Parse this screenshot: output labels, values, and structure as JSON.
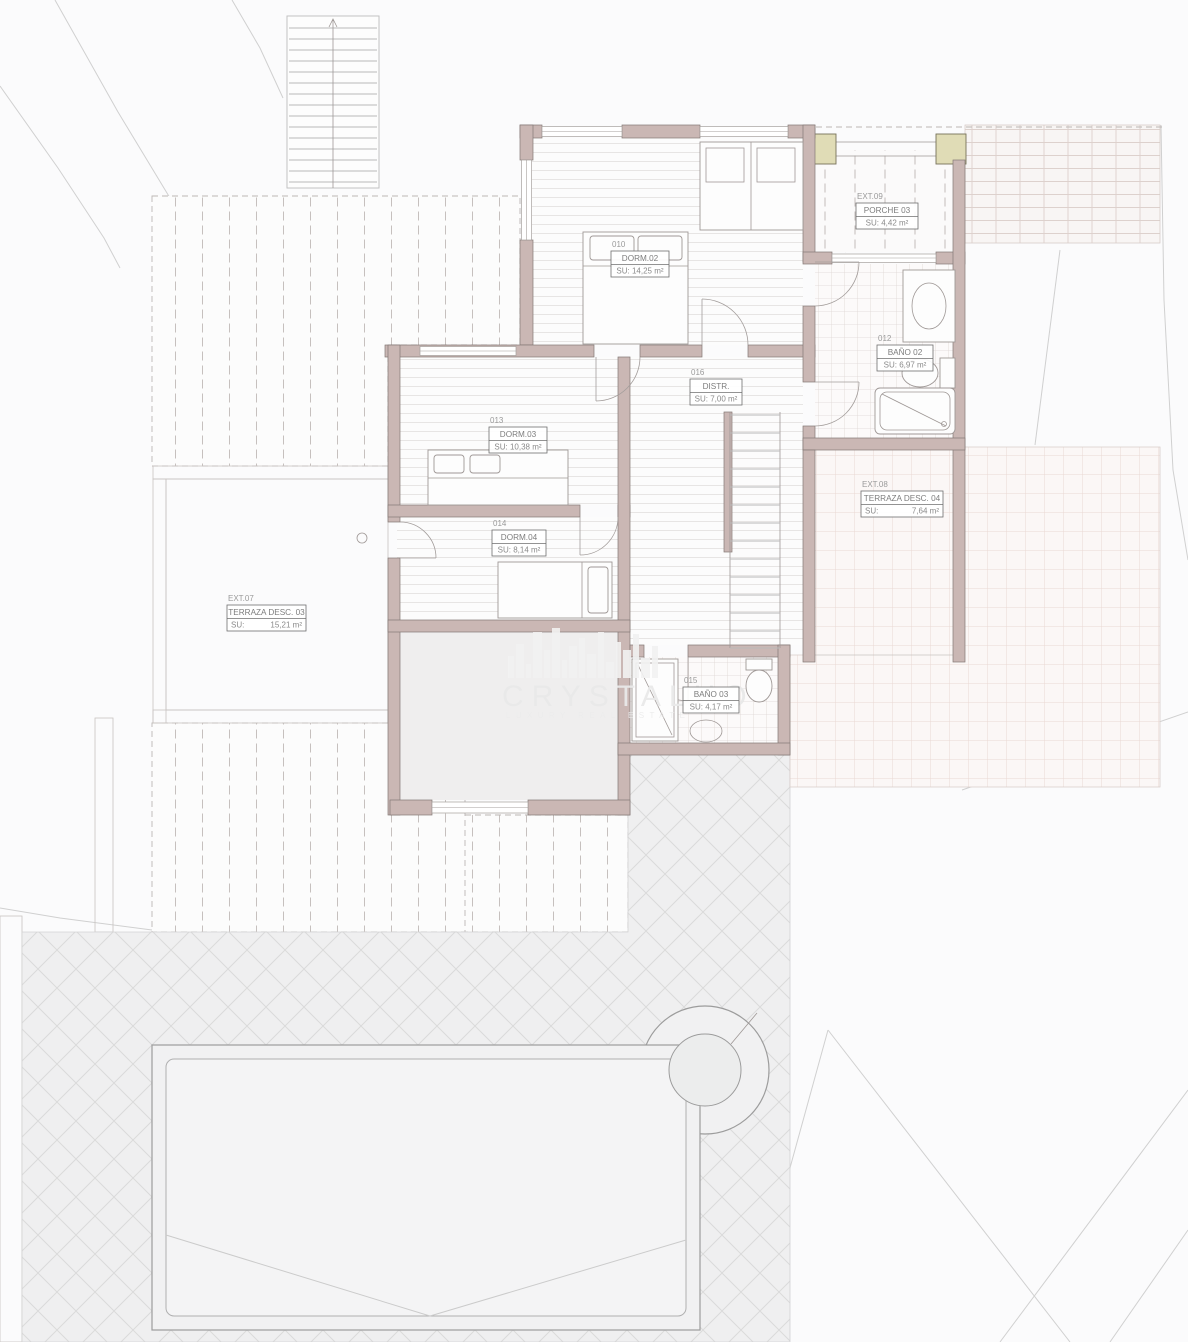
{
  "plan": {
    "type": "architectural-floor-plan",
    "watermark": {
      "brand": "CRYSTALHO",
      "tagline": "LUXURY REAL ESTATE"
    }
  },
  "rooms": {
    "dorm02": {
      "number": "010",
      "name": "DORM.02",
      "area": "SU: 14,25 m²"
    },
    "dorm03": {
      "number": "013",
      "name": "DORM.03",
      "area": "SU: 10,38 m²"
    },
    "dorm04": {
      "number": "014",
      "name": "DORM.04",
      "area": "SU: 8,14 m²"
    },
    "distr": {
      "number": "016",
      "name": "DISTR.",
      "area": "SU: 7,00 m²"
    },
    "bano02": {
      "number": "012",
      "name": "BAÑO 02",
      "area": "SU: 6,97 m²"
    },
    "bano03": {
      "number": "015",
      "name": "BAÑO 03",
      "area": "SU: 4,17 m²"
    },
    "porche03": {
      "number": "EXT.09",
      "name": "PORCHE 03",
      "area": "SU: 4,42 m²"
    },
    "terraza04": {
      "number": "EXT.08",
      "name": "TERRAZA DESC. 04",
      "area_label": "SU:",
      "area_value": "7,64 m²"
    },
    "terraza03": {
      "number": "EXT.07",
      "name": "TERRAZA DESC. 03",
      "area_label": "SU:",
      "area_value": "15,21 m²"
    }
  },
  "colors": {
    "wall_fill": "#cab7b4",
    "post_fill": "#e0dcb6",
    "paper": "#fbfbfc",
    "pool_outline": "#9c9c9c",
    "pink_tile_line": "#e9d8d4",
    "diamond_paving_bg": "#efeff0"
  }
}
